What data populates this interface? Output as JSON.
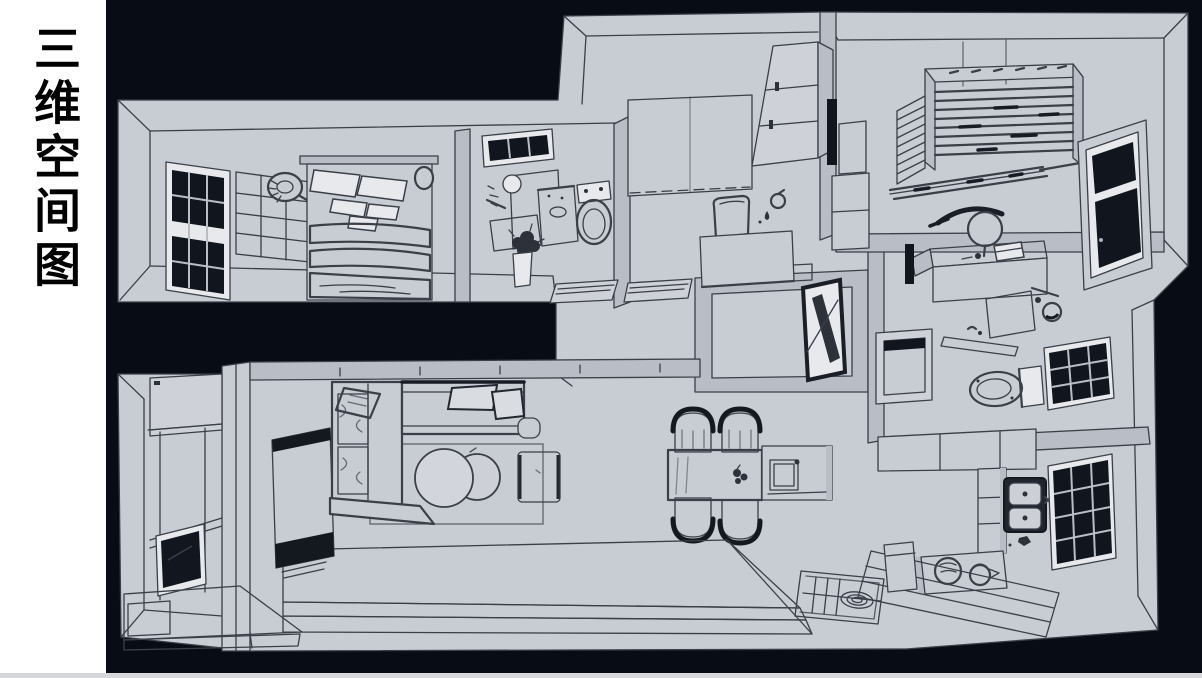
{
  "title_panel": {
    "text": "三维空间图"
  },
  "colors": {
    "background": "#070c15",
    "panel": "#ffffff",
    "bottom_strip": "#d6d8dc",
    "title_text": "#000000",
    "plan_fill": "#c8ccd3",
    "plan_fill_dim": "#b9bec6",
    "plan_line": "#3a3f48",
    "plan_dark": "#10151e",
    "plan_white": "#e7e9ed"
  },
  "floorplan": {
    "kind": "hand-drawn 3d apartment floor plan, monochrome line art",
    "areas": [
      "bedroom",
      "bathroom",
      "hallway",
      "study-room",
      "utility",
      "second-bathroom",
      "kitchen",
      "dining-area",
      "living-room",
      "balcony",
      "entryway"
    ]
  }
}
